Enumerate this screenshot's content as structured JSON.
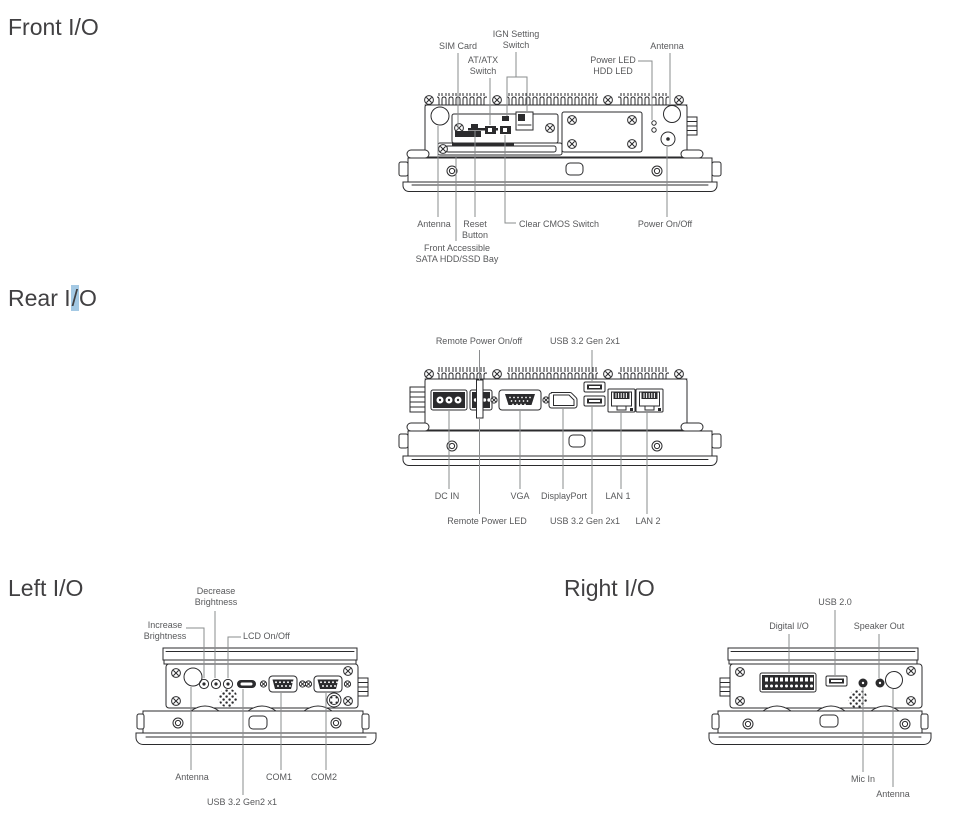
{
  "page": {
    "colors": {
      "bg": "#ffffff",
      "ink": "#2b2b2d",
      "label": "#58595b",
      "heading": "#414042",
      "highlight": "#a4c9e4",
      "leader": "#8a8c8e"
    }
  },
  "sections": {
    "front": {
      "title": "Front I/O",
      "labels": {
        "sim_card": "SIM Card",
        "ign_switch": "IGN Setting\nSwitch",
        "atx_switch": "AT/ATX\nSwitch",
        "power_hdd_led": "Power LED\nHDD LED",
        "antenna_top": "Antenna",
        "antenna_bottom": "Antenna",
        "reset_button": "Reset\nButton",
        "sata_bay": "Front Accessible\nSATA HDD/SSD Bay",
        "clear_cmos": "Clear CMOS Switch",
        "power_on_off": "Power On/Off"
      }
    },
    "rear": {
      "title_pre": "Rear I",
      "title_hl": "/",
      "title_post": "O",
      "labels": {
        "remote_power_on_off": "Remote Power On/off",
        "usb32_top": "USB 3.2 Gen 2x1",
        "dc_in": "DC IN",
        "vga": "VGA",
        "displayport": "DisplayPort",
        "lan1": "LAN 1",
        "remote_power_led": "Remote Power LED",
        "usb32_bottom": "USB 3.2 Gen 2x1",
        "lan2": "LAN 2"
      }
    },
    "left": {
      "title": "Left I/O",
      "labels": {
        "decrease_brightness": "Decrease\nBrightness",
        "increase_brightness": "Increase\nBrightness",
        "lcd_on_off": "LCD On/Off",
        "antenna": "Antenna",
        "com1": "COM1",
        "com2": "COM2",
        "usb32_gen2": "USB 3.2 Gen2 x1"
      }
    },
    "right": {
      "title": "Right I/O",
      "labels": {
        "usb20": "USB 2.0",
        "digital_io": "Digital I/O",
        "speaker_out": "Speaker Out",
        "mic_in": "Mic In",
        "antenna": "Antenna"
      }
    }
  }
}
